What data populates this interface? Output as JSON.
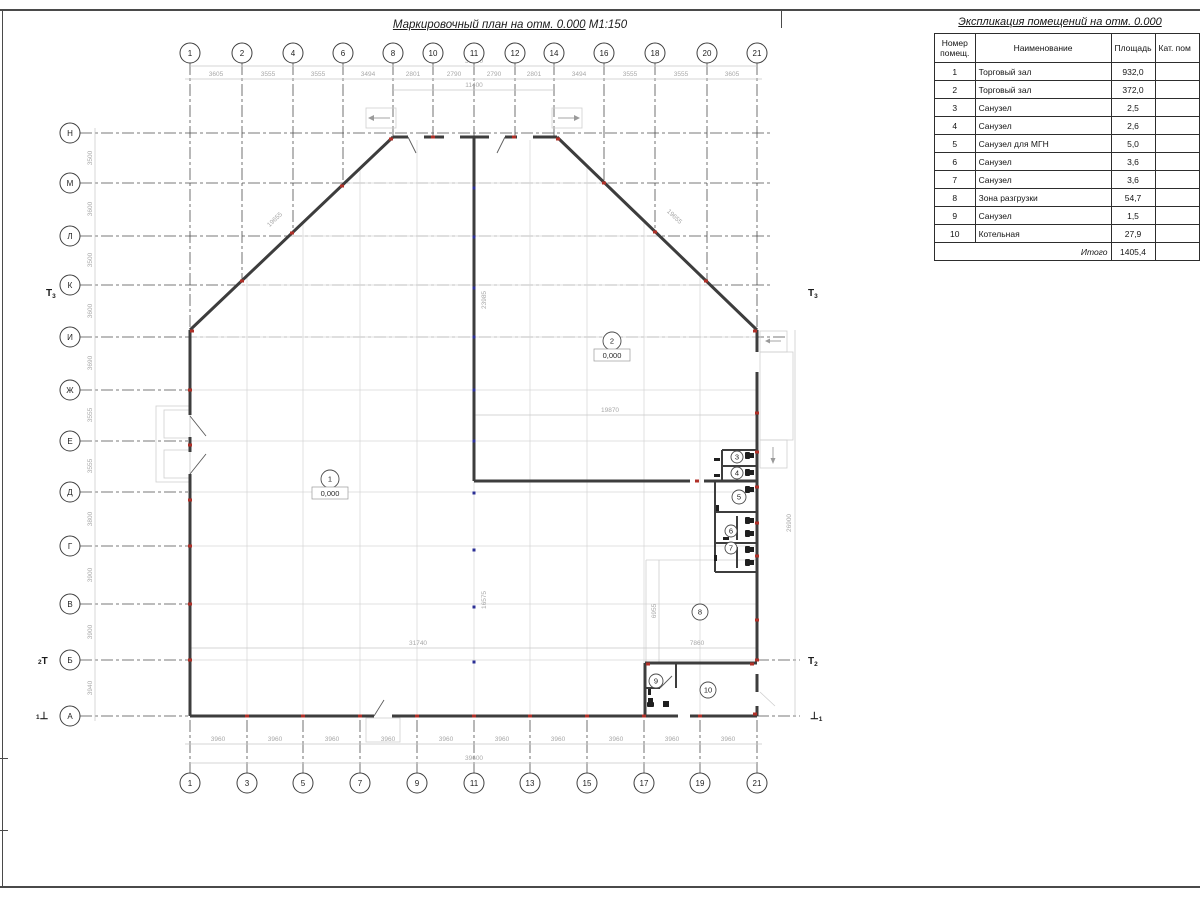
{
  "plan": {
    "title": "Маркировочный план на отм. 0.000",
    "scale": "М1:150",
    "axes_top": {
      "y": 53,
      "items": [
        {
          "label": "1",
          "x": 190
        },
        {
          "label": "2",
          "x": 242
        },
        {
          "label": "4",
          "x": 293
        },
        {
          "label": "6",
          "x": 343
        },
        {
          "label": "8",
          "x": 393
        },
        {
          "label": "10",
          "x": 433
        },
        {
          "label": "11",
          "x": 474
        },
        {
          "label": "12",
          "x": 515
        },
        {
          "label": "14",
          "x": 554
        },
        {
          "label": "16",
          "x": 604
        },
        {
          "label": "18",
          "x": 655
        },
        {
          "label": "20",
          "x": 707
        },
        {
          "label": "21",
          "x": 757
        }
      ]
    },
    "axes_bottom": {
      "y": 783,
      "items": [
        {
          "label": "1",
          "x": 190
        },
        {
          "label": "3",
          "x": 247
        },
        {
          "label": "5",
          "x": 303
        },
        {
          "label": "7",
          "x": 360
        },
        {
          "label": "9",
          "x": 417
        },
        {
          "label": "11",
          "x": 474
        },
        {
          "label": "13",
          "x": 530
        },
        {
          "label": "15",
          "x": 587
        },
        {
          "label": "17",
          "x": 644
        },
        {
          "label": "19",
          "x": 700
        },
        {
          "label": "21",
          "x": 757
        }
      ]
    },
    "axes_left": {
      "x": 70,
      "items": [
        {
          "label": "Н",
          "y": 133
        },
        {
          "label": "М",
          "y": 183
        },
        {
          "label": "Л",
          "y": 236
        },
        {
          "label": "К",
          "y": 285
        },
        {
          "label": "И",
          "y": 337
        },
        {
          "label": "Ж",
          "y": 390
        },
        {
          "label": "Е",
          "y": 441
        },
        {
          "label": "Д",
          "y": 492
        },
        {
          "label": "Г",
          "y": 546
        },
        {
          "label": "В",
          "y": 604
        },
        {
          "label": "Б",
          "y": 660
        },
        {
          "label": "А",
          "y": 716
        }
      ]
    },
    "rooms": [
      {
        "num": "1",
        "x": 330,
        "y": 479,
        "r": 9,
        "elev": "0,000"
      },
      {
        "num": "2",
        "x": 612,
        "y": 341,
        "r": 9,
        "elev": "0,000"
      },
      {
        "num": "3",
        "x": 737,
        "y": 457,
        "r": 6
      },
      {
        "num": "4",
        "x": 737,
        "y": 473,
        "r": 6
      },
      {
        "num": "5",
        "x": 739,
        "y": 497,
        "r": 7
      },
      {
        "num": "6",
        "x": 731,
        "y": 531,
        "r": 6
      },
      {
        "num": "7",
        "x": 731,
        "y": 548,
        "r": 6
      },
      {
        "num": "8",
        "x": 700,
        "y": 612,
        "r": 8
      },
      {
        "num": "9",
        "x": 656,
        "y": 681,
        "r": 7
      },
      {
        "num": "10",
        "x": 708,
        "y": 690,
        "r": 8
      }
    ],
    "dims": [
      {
        "t": "3605",
        "x": 216,
        "y": 76
      },
      {
        "t": "3555",
        "x": 268,
        "y": 76
      },
      {
        "t": "3555",
        "x": 318,
        "y": 76
      },
      {
        "t": "3494",
        "x": 368,
        "y": 76
      },
      {
        "t": "2801",
        "x": 413,
        "y": 76
      },
      {
        "t": "2790",
        "x": 454,
        "y": 76
      },
      {
        "t": "2790",
        "x": 494,
        "y": 76
      },
      {
        "t": "2801",
        "x": 534,
        "y": 76
      },
      {
        "t": "3494",
        "x": 579,
        "y": 76
      },
      {
        "t": "3555",
        "x": 630,
        "y": 76
      },
      {
        "t": "3555",
        "x": 681,
        "y": 76
      },
      {
        "t": "3605",
        "x": 732,
        "y": 76
      },
      {
        "t": "39600",
        "x": 474,
        "y": 63
      },
      {
        "t": "11400",
        "x": 474,
        "y": 87
      },
      {
        "t": "3960",
        "x": 218,
        "y": 741
      },
      {
        "t": "3960",
        "x": 275,
        "y": 741
      },
      {
        "t": "3960",
        "x": 332,
        "y": 741
      },
      {
        "t": "3960",
        "x": 388,
        "y": 741
      },
      {
        "t": "3960",
        "x": 446,
        "y": 741
      },
      {
        "t": "3960",
        "x": 502,
        "y": 741
      },
      {
        "t": "3960",
        "x": 558,
        "y": 741
      },
      {
        "t": "3960",
        "x": 616,
        "y": 741
      },
      {
        "t": "3960",
        "x": 672,
        "y": 741
      },
      {
        "t": "3960",
        "x": 728,
        "y": 741
      },
      {
        "t": "39600",
        "x": 474,
        "y": 760
      },
      {
        "t": "3500",
        "x": 92,
        "y": 158,
        "r": -90
      },
      {
        "t": "3600",
        "x": 92,
        "y": 209,
        "r": -90
      },
      {
        "t": "3500",
        "x": 92,
        "y": 260,
        "r": -90
      },
      {
        "t": "3600",
        "x": 92,
        "y": 311,
        "r": -90
      },
      {
        "t": "3690",
        "x": 92,
        "y": 363,
        "r": -90
      },
      {
        "t": "3555",
        "x": 92,
        "y": 415,
        "r": -90
      },
      {
        "t": "3555",
        "x": 92,
        "y": 466,
        "r": -90
      },
      {
        "t": "3800",
        "x": 92,
        "y": 519,
        "r": -90
      },
      {
        "t": "3900",
        "x": 92,
        "y": 575,
        "r": -90
      },
      {
        "t": "3900",
        "x": 92,
        "y": 632,
        "r": -90
      },
      {
        "t": "3940",
        "x": 92,
        "y": 688,
        "r": -90
      },
      {
        "t": "26900",
        "x": 791,
        "y": 523,
        "r": -90
      },
      {
        "t": "19870",
        "x": 610,
        "y": 412
      },
      {
        "t": "31740",
        "x": 418,
        "y": 645
      },
      {
        "t": "7860",
        "x": 697,
        "y": 645
      },
      {
        "t": "23985",
        "x": 486,
        "y": 300,
        "r": -90
      },
      {
        "t": "16575",
        "x": 486,
        "y": 600,
        "r": -90
      },
      {
        "t": "6955",
        "x": 656,
        "y": 611,
        "r": -90
      },
      {
        "t": "19655",
        "x": 276,
        "y": 221,
        "r": -43.5
      },
      {
        "t": "19655",
        "x": 673,
        "y": 218,
        "r": 43.5
      }
    ],
    "section_marks": [
      {
        "pre": "",
        "main": "Т",
        "sub": "3",
        "x": 46,
        "y": 296
      },
      {
        "pre": "2",
        "main": "Т",
        "sub": "",
        "x": 38,
        "y": 664
      },
      {
        "pre": "1",
        "main": "⊥",
        "sub": "",
        "x": 36,
        "y": 719
      },
      {
        "pre": "",
        "main": "Т",
        "sub": "3",
        "x": 808,
        "y": 296
      },
      {
        "pre": "",
        "main": "Т",
        "sub": "2",
        "x": 808,
        "y": 664
      },
      {
        "pre": "",
        "main": "⊥",
        "sub": "1",
        "x": 810,
        "y": 719
      }
    ],
    "markers": {
      "colors": {
        "red": "#b03028",
        "blue": "#2b2f95"
      },
      "red": [
        [
          433,
          137
        ],
        [
          514,
          137
        ],
        [
          391,
          139
        ],
        [
          558,
          139
        ],
        [
          242,
          281
        ],
        [
          292,
          233
        ],
        [
          342,
          186
        ],
        [
          604,
          183
        ],
        [
          655,
          232
        ],
        [
          706,
          281
        ],
        [
          192,
          331
        ],
        [
          755,
          331
        ],
        [
          190,
          390
        ],
        [
          190,
          445
        ],
        [
          190,
          500
        ],
        [
          190,
          546
        ],
        [
          190,
          604
        ],
        [
          190,
          660
        ],
        [
          247,
          716
        ],
        [
          303,
          716
        ],
        [
          360,
          716
        ],
        [
          417,
          716
        ],
        [
          474,
          716
        ],
        [
          530,
          716
        ],
        [
          587,
          716
        ],
        [
          644,
          716
        ],
        [
          700,
          716
        ],
        [
          755,
          714
        ],
        [
          757,
          413
        ],
        [
          757,
          452
        ],
        [
          757,
          487
        ],
        [
          757,
          523
        ],
        [
          757,
          556
        ],
        [
          757,
          620
        ],
        [
          757,
          660
        ],
        [
          697,
          481
        ],
        [
          648,
          664
        ],
        [
          752,
          664
        ]
      ],
      "blue": [
        [
          474,
          188
        ],
        [
          474,
          237
        ],
        [
          474,
          288
        ],
        [
          474,
          337
        ],
        [
          474,
          390
        ],
        [
          474,
          441
        ],
        [
          474,
          493
        ],
        [
          474,
          550
        ],
        [
          474,
          607
        ],
        [
          474,
          662
        ]
      ]
    }
  },
  "table": {
    "title": "Экспликация помещений на отм. 0.000",
    "headers": {
      "num": "Номер помещ.",
      "name": "Наименование",
      "area": "Площадь",
      "cat": "Кат. пом"
    },
    "rows": [
      {
        "num": "1",
        "name": "Торговый зал",
        "area": "932,0"
      },
      {
        "num": "2",
        "name": "Торговый зал",
        "area": "372,0"
      },
      {
        "num": "3",
        "name": "Санузел",
        "area": "2,5"
      },
      {
        "num": "4",
        "name": "Санузел",
        "area": "2,6"
      },
      {
        "num": "5",
        "name": "Санузел для МГН",
        "area": "5,0"
      },
      {
        "num": "6",
        "name": "Санузел",
        "area": "3,6"
      },
      {
        "num": "7",
        "name": "Санузел",
        "area": "3,6"
      },
      {
        "num": "8",
        "name": "Зона разгрузки",
        "area": "54,7"
      },
      {
        "num": "9",
        "name": "Санузел",
        "area": "1,5"
      },
      {
        "num": "10",
        "name": "Котельная",
        "area": "27,9"
      }
    ],
    "total_label": "Итого",
    "total_value": "1405,4"
  }
}
